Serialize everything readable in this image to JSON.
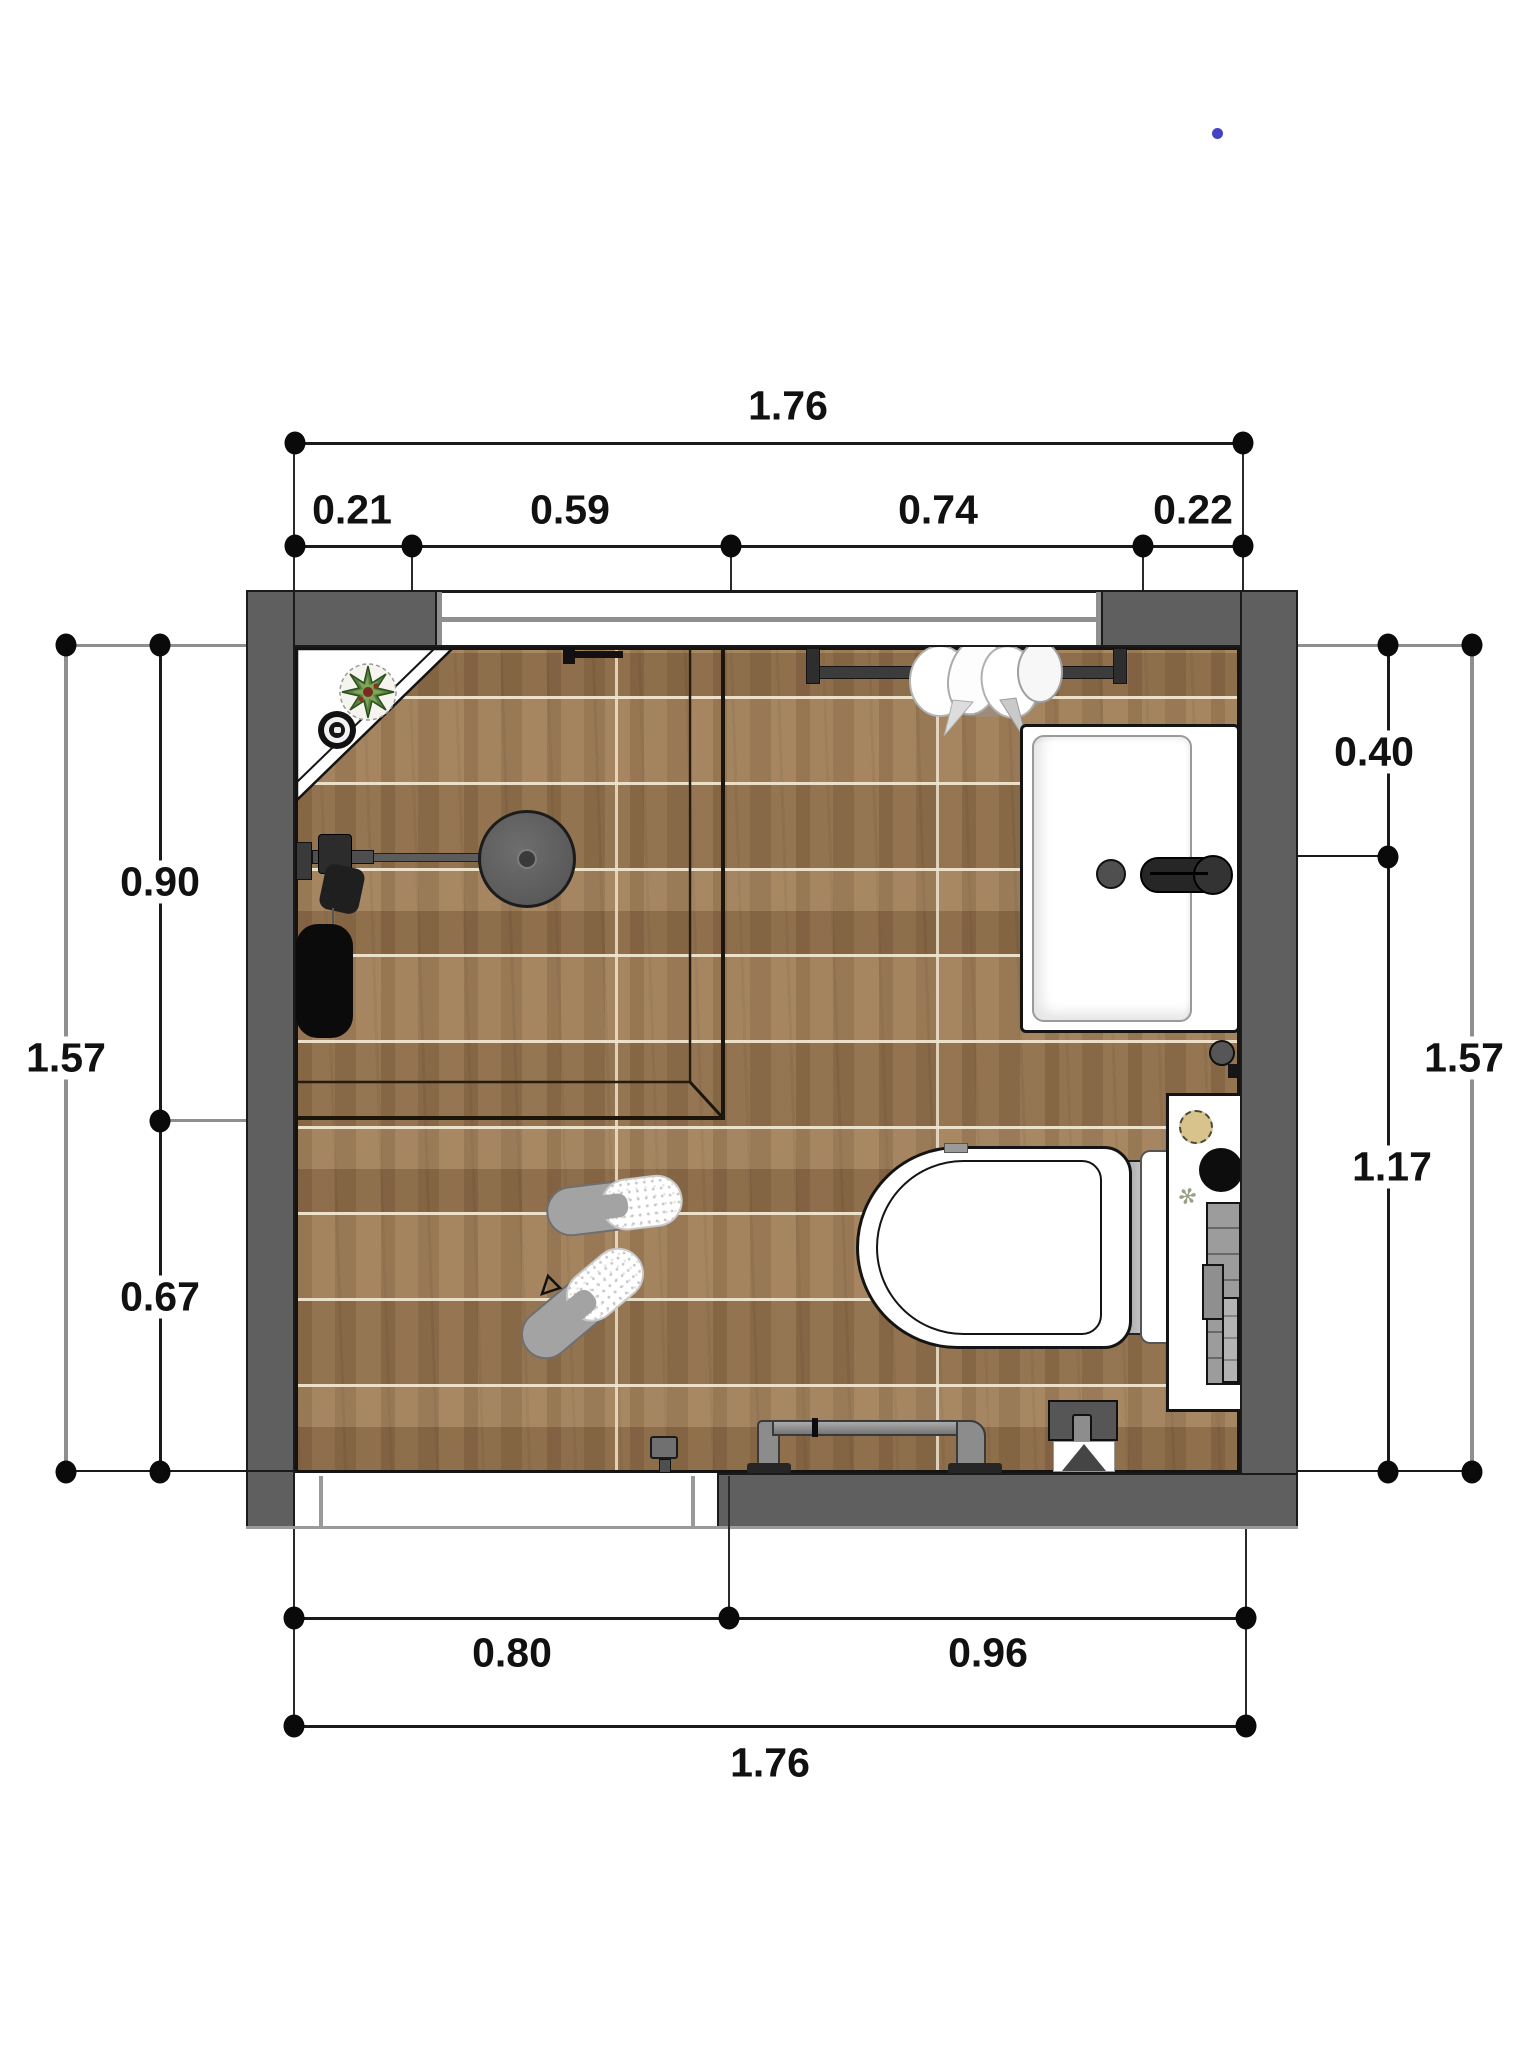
{
  "page": {
    "background": "#ffffff"
  },
  "marker_dot": {
    "color": "#4343c6"
  },
  "dimensions": {
    "top": {
      "total": "1.76",
      "segments": [
        "0.21",
        "0.59",
        "0.74",
        "0.22"
      ]
    },
    "bottom": {
      "total": "1.76",
      "segments": [
        "0.80",
        "0.96"
      ]
    },
    "left": {
      "total": "1.57",
      "segments": [
        "0.90",
        "0.67"
      ]
    },
    "right": {
      "total": "1.57",
      "segments": [
        "0.40",
        "1.17"
      ]
    }
  },
  "palette": {
    "wall_gray": "#5f5f5f",
    "floor_wood": "#9b7a55",
    "plank_joint": "#e8ddc5",
    "dim_line": "#1a1a1a",
    "extension_line": "#8f8f8f",
    "fixture_white": "#ffffff",
    "fixture_dark": "#2e2e2e",
    "shower_head_gray": "#5d5d5d",
    "pipe_gray": "#8c8c8c",
    "bag_black": "#0b0b0b",
    "plant_green": "#55813c",
    "jar_tan": "#d9c38c",
    "marker_blue": "#4343c6"
  }
}
